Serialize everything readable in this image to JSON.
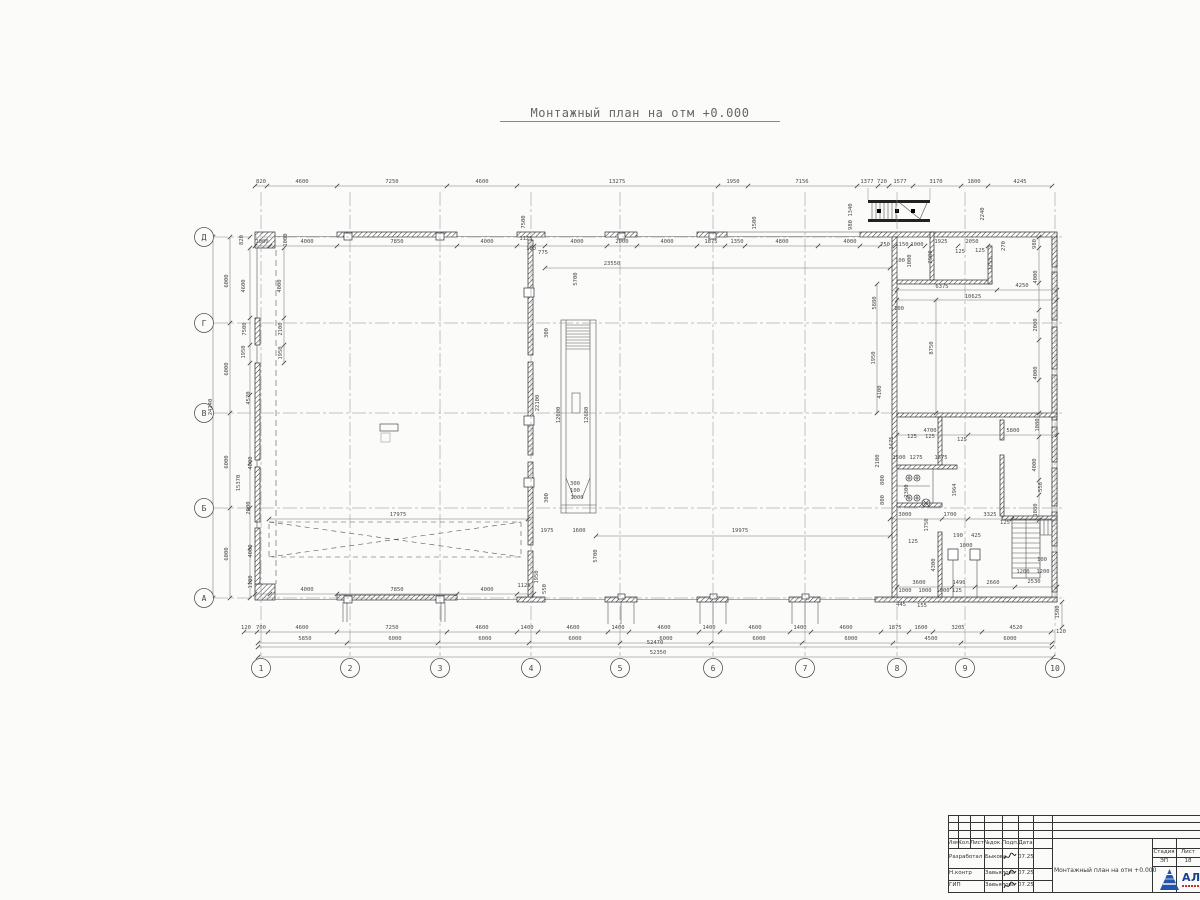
{
  "title": "Монтажный план на отм +0.000",
  "colors": {
    "logo_blue": "#2553a8",
    "logo_text_blue": "#1b3f94",
    "line": "#4a4a4a"
  },
  "axes": {
    "rows": [
      {
        "label": "Д",
        "y": 237
      },
      {
        "label": "Г",
        "y": 323
      },
      {
        "label": "В",
        "y": 413
      },
      {
        "label": "Б",
        "y": 508
      },
      {
        "label": "А",
        "y": 598
      }
    ],
    "cols": [
      {
        "label": "1",
        "x": 261
      },
      {
        "label": "2",
        "x": 350
      },
      {
        "label": "3",
        "x": 440
      },
      {
        "label": "4",
        "x": 531
      },
      {
        "label": "5",
        "x": 620
      },
      {
        "label": "6",
        "x": 713
      },
      {
        "label": "7",
        "x": 805
      },
      {
        "label": "8",
        "x": 897
      },
      {
        "label": "9",
        "x": 965
      },
      {
        "label": "10",
        "x": 1055
      }
    ]
  },
  "dims": [
    [
      261,
      183,
      "820"
    ],
    [
      302,
      183,
      "4600"
    ],
    [
      392,
      183,
      "7250"
    ],
    [
      482,
      183,
      "4600"
    ],
    [
      617,
      183,
      "13275"
    ],
    [
      733,
      183,
      "1950"
    ],
    [
      802,
      183,
      "7156"
    ],
    [
      867,
      183,
      "1377"
    ],
    [
      882,
      183,
      "720"
    ],
    [
      900,
      183,
      "1577"
    ],
    [
      936,
      183,
      "3170"
    ],
    [
      974,
      183,
      "1800"
    ],
    [
      1020,
      183,
      "4245"
    ],
    [
      262,
      243,
      "1000"
    ],
    [
      287,
      240,
      "1000",
      1
    ],
    [
      307,
      243,
      "4000"
    ],
    [
      397,
      243,
      "7850"
    ],
    [
      487,
      243,
      "4000"
    ],
    [
      526,
      240,
      "1125"
    ],
    [
      531,
      250,
      "100"
    ],
    [
      543,
      254,
      "775"
    ],
    [
      577,
      243,
      "4000"
    ],
    [
      622,
      243,
      "2000"
    ],
    [
      667,
      243,
      "4000"
    ],
    [
      711,
      243,
      "1875"
    ],
    [
      737,
      243,
      "1350"
    ],
    [
      782,
      243,
      "4800"
    ],
    [
      850,
      243,
      "4000"
    ],
    [
      885,
      246,
      "750"
    ],
    [
      902,
      246,
      "1150"
    ],
    [
      917,
      246,
      "1000"
    ],
    [
      941,
      243,
      "1925"
    ],
    [
      972,
      243,
      "2050"
    ],
    [
      1005,
      246,
      "270",
      1
    ],
    [
      525,
      222,
      "7500",
      1
    ],
    [
      756,
      223,
      "1500",
      1
    ],
    [
      852,
      210,
      "1340",
      1
    ],
    [
      852,
      225,
      "980",
      1
    ],
    [
      984,
      214,
      "2240",
      1
    ],
    [
      932,
      257,
      "2900",
      1
    ],
    [
      900,
      262,
      "100"
    ],
    [
      911,
      261,
      "1000",
      1
    ],
    [
      960,
      253,
      "125"
    ],
    [
      980,
      252,
      "125"
    ],
    [
      992,
      264,
      "1755",
      1
    ],
    [
      942,
      288,
      "6375"
    ],
    [
      1022,
      287,
      "4250"
    ],
    [
      973,
      298,
      "10625"
    ],
    [
      876,
      303,
      "5880",
      1
    ],
    [
      899,
      310,
      "100"
    ],
    [
      933,
      348,
      "8750",
      1
    ],
    [
      875,
      358,
      "1950",
      1
    ],
    [
      881,
      392,
      "4100",
      1
    ],
    [
      1036,
      244,
      "980",
      1
    ],
    [
      1037,
      277,
      "4000",
      1
    ],
    [
      1037,
      325,
      "2000",
      1
    ],
    [
      1037,
      373,
      "4000",
      1
    ],
    [
      1039,
      425,
      "1080",
      1
    ],
    [
      1036,
      465,
      "4000",
      1
    ],
    [
      1042,
      487,
      "558",
      1
    ],
    [
      1037,
      510,
      "1080",
      1
    ],
    [
      930,
      432,
      "4700"
    ],
    [
      1013,
      432,
      "5800"
    ],
    [
      893,
      443,
      "3475",
      1
    ],
    [
      962,
      441,
      "125"
    ],
    [
      899,
      459,
      "1500"
    ],
    [
      916,
      459,
      "1275"
    ],
    [
      941,
      459,
      "1675"
    ],
    [
      879,
      461,
      "2100",
      1
    ],
    [
      912,
      438,
      "125"
    ],
    [
      930,
      438,
      "125"
    ],
    [
      908,
      491,
      "2300",
      1
    ],
    [
      956,
      490,
      "1964",
      1
    ],
    [
      884,
      480,
      "800",
      1
    ],
    [
      884,
      500,
      "800",
      1
    ],
    [
      905,
      516,
      "3000"
    ],
    [
      950,
      516,
      "1700"
    ],
    [
      990,
      516,
      "3325"
    ],
    [
      928,
      525,
      "1750",
      1
    ],
    [
      913,
      543,
      "125"
    ],
    [
      958,
      537,
      "190"
    ],
    [
      976,
      537,
      "425"
    ],
    [
      966,
      547,
      "1000"
    ],
    [
      935,
      565,
      "4300",
      1
    ],
    [
      1005,
      524,
      "125"
    ],
    [
      1042,
      561,
      "100"
    ],
    [
      1023,
      573,
      "1200"
    ],
    [
      1043,
      573,
      "1200"
    ],
    [
      1034,
      583,
      "2530"
    ],
    [
      959,
      584,
      "1490"
    ],
    [
      993,
      584,
      "2660"
    ],
    [
      919,
      584,
      "3600"
    ],
    [
      901,
      606,
      "445"
    ],
    [
      922,
      607,
      "155"
    ],
    [
      905,
      592,
      "1000"
    ],
    [
      925,
      592,
      "1000"
    ],
    [
      943,
      592,
      "1000"
    ],
    [
      957,
      592,
      "125"
    ],
    [
      612,
      265,
      "23550"
    ],
    [
      577,
      279,
      "5700",
      1
    ],
    [
      560,
      415,
      "12000",
      1
    ],
    [
      588,
      415,
      "12680",
      1
    ],
    [
      539,
      403,
      "22100",
      1
    ],
    [
      548,
      333,
      "300",
      1
    ],
    [
      575,
      485,
      "300"
    ],
    [
      575,
      492,
      "100"
    ],
    [
      577,
      499,
      "1000"
    ],
    [
      548,
      498,
      "300",
      1
    ],
    [
      547,
      532,
      "1975"
    ],
    [
      579,
      532,
      "1600"
    ],
    [
      740,
      532,
      "19975"
    ],
    [
      597,
      556,
      "5700",
      1
    ],
    [
      398,
      516,
      "17975"
    ],
    [
      307,
      591,
      "4000"
    ],
    [
      397,
      591,
      "7850"
    ],
    [
      487,
      591,
      "4000"
    ],
    [
      524,
      587,
      "1125"
    ],
    [
      538,
      577,
      "1950",
      1
    ],
    [
      546,
      589,
      "550",
      1
    ],
    [
      246,
      629,
      "120"
    ],
    [
      261,
      629,
      "700"
    ],
    [
      302,
      629,
      "4600"
    ],
    [
      392,
      629,
      "7250"
    ],
    [
      482,
      629,
      "4600"
    ],
    [
      527,
      629,
      "1400"
    ],
    [
      573,
      629,
      "4600"
    ],
    [
      618,
      629,
      "1400"
    ],
    [
      664,
      629,
      "4600"
    ],
    [
      709,
      629,
      "1400"
    ],
    [
      755,
      629,
      "4600"
    ],
    [
      800,
      629,
      "1400"
    ],
    [
      846,
      629,
      "4600"
    ],
    [
      895,
      629,
      "1875"
    ],
    [
      921,
      629,
      "1600"
    ],
    [
      958,
      629,
      "3205"
    ],
    [
      1016,
      629,
      "4520"
    ],
    [
      1061,
      633,
      "120"
    ],
    [
      305,
      640,
      "5850"
    ],
    [
      395,
      640,
      "6000"
    ],
    [
      485,
      640,
      "6000"
    ],
    [
      575,
      640,
      "6000"
    ],
    [
      666,
      640,
      "6000"
    ],
    [
      759,
      640,
      "6000"
    ],
    [
      851,
      640,
      "6000"
    ],
    [
      931,
      640,
      "4500"
    ],
    [
      1010,
      640,
      "6000"
    ],
    [
      655,
      644,
      "52470"
    ],
    [
      658,
      654,
      "52350"
    ],
    [
      228,
      281,
      "6000",
      1
    ],
    [
      228,
      369,
      "6000",
      1
    ],
    [
      228,
      462,
      "6000",
      1
    ],
    [
      228,
      554,
      "6000",
      1
    ],
    [
      212,
      407,
      "24240",
      1
    ],
    [
      245,
      286,
      "4600",
      1
    ],
    [
      246,
      329,
      "7500",
      1
    ],
    [
      245,
      352,
      "1950",
      1
    ],
    [
      281,
      286,
      "4000",
      1
    ],
    [
      282,
      329,
      "2100",
      1
    ],
    [
      282,
      353,
      "1950",
      1
    ],
    [
      250,
      398,
      "4570",
      1
    ],
    [
      252,
      463,
      "4000",
      1
    ],
    [
      240,
      483,
      "15370",
      1
    ],
    [
      250,
      508,
      "2000",
      1
    ],
    [
      252,
      551,
      "4000",
      1
    ],
    [
      252,
      582,
      "1100",
      1
    ],
    [
      243,
      240,
      "820",
      1
    ],
    [
      1059,
      612,
      "1500",
      1
    ]
  ],
  "titleblock": {
    "headers": [
      "Изм.",
      "Кол.",
      "Лист",
      "№док.",
      "Подп.",
      "Дата"
    ],
    "rows": [
      {
        "role": "Разработал",
        "name": "Быкова",
        "date": "07.25"
      },
      {
        "role": "Н.контр",
        "name": "Завьялова",
        "date": "07.25"
      },
      {
        "role": "ГИП",
        "name": "Завьялова",
        "date": "07.25"
      }
    ],
    "doc_title": "Монтажный план на отм +0.000",
    "stage_label": "Стадия",
    "sheet_label": "Лист",
    "stage": "ЭП",
    "sheet": "18",
    "logo_text": "АЛЬЯ"
  }
}
